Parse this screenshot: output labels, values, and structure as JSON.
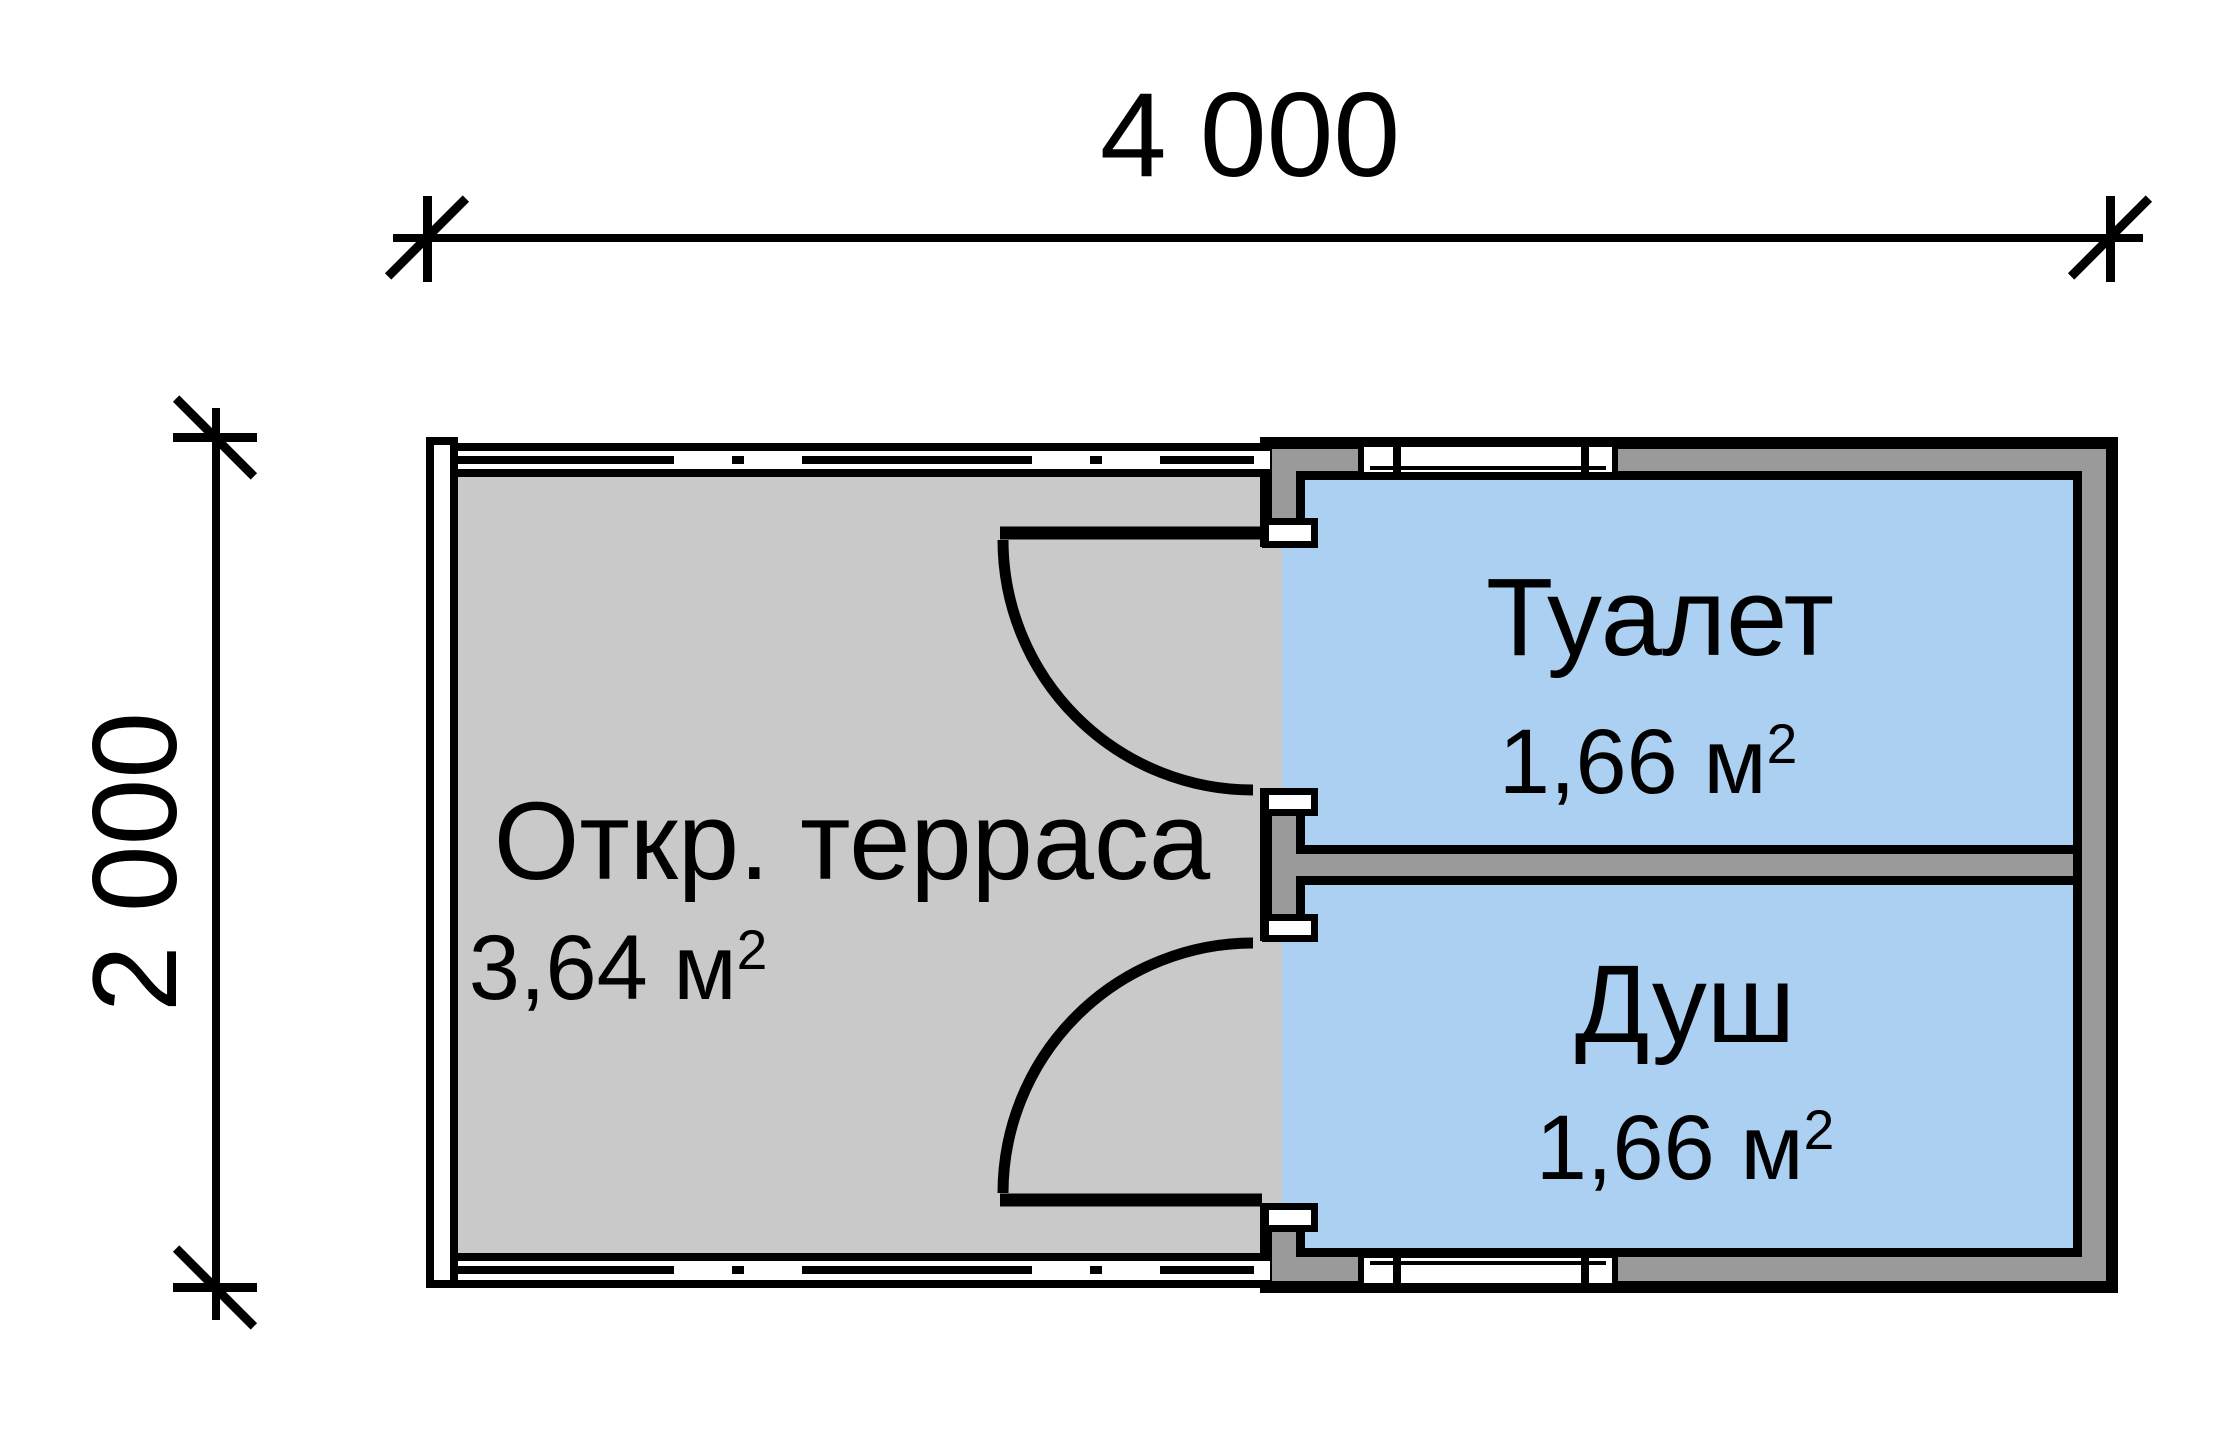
{
  "plan": {
    "type": "floor-plan",
    "dimensions": {
      "width_label": "4 000",
      "height_label": "2 000"
    },
    "rooms": {
      "terrace": {
        "name": "Откр. терраса",
        "area": "3,64 м",
        "area_exp": "2"
      },
      "toilet": {
        "name": "Туалет",
        "area": "1,66 м",
        "area_exp": "2"
      },
      "shower": {
        "name": "Душ",
        "area": "1,66 м",
        "area_exp": "2"
      }
    }
  },
  "colors": {
    "floor": "#c9c9c9",
    "wall": "#9a9a9a",
    "room": "#acd0f2",
    "line": "#000000",
    "paper": "#ffffff"
  }
}
